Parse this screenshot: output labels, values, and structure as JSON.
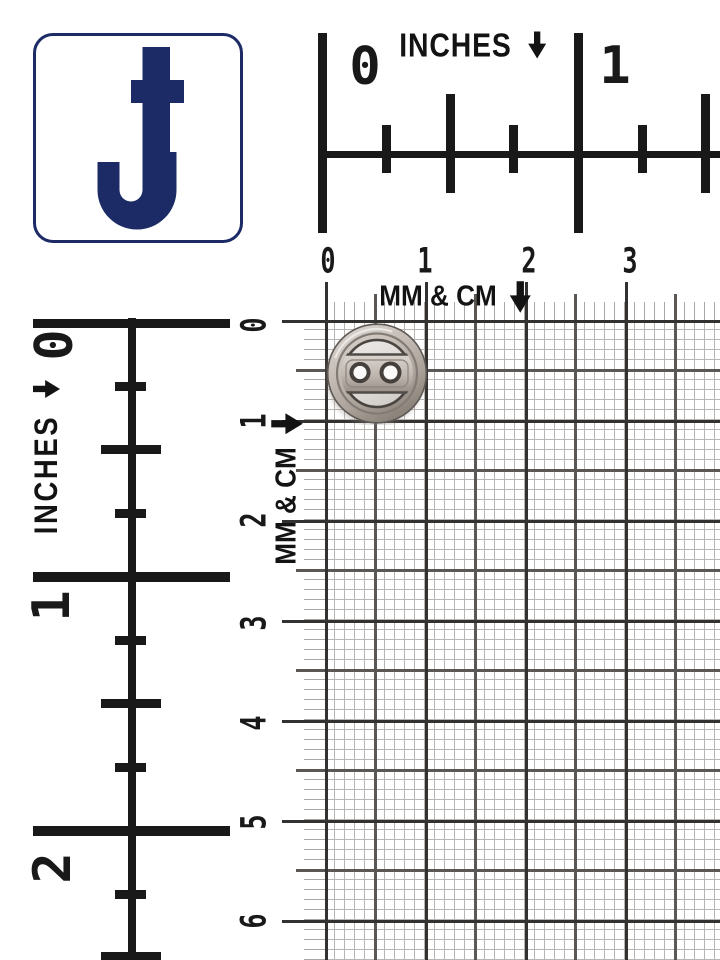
{
  "photo": {
    "description": "Silver two-hole sewing button photographed on millimeter graph paper with inch rulers for scale",
    "background": "#ffffff"
  },
  "logo": {
    "letter": "J",
    "color": "#1c2b66"
  },
  "top_inch_ruler": {
    "label": "INCHES",
    "numbers": [
      "0",
      "1"
    ]
  },
  "left_inch_ruler": {
    "label": "INCHES",
    "numbers": [
      "0",
      "1",
      "2"
    ]
  },
  "mm_cm_grid": {
    "label": "MM & CM",
    "x_numbers": [
      "0",
      "1",
      "2",
      "3"
    ],
    "y_numbers": [
      "0",
      "1",
      "2",
      "3",
      "4",
      "5",
      "6"
    ]
  },
  "button": {
    "type": "two-hole metal button",
    "finish": "silver",
    "holes": 2,
    "diameter_cm": 1
  },
  "colors": {
    "ink": "#191919",
    "navy": "#1c2b66",
    "grid_mm_line": "#b7b4b1",
    "grid_5mm_line": "#5b5754",
    "grid_cm_line": "#343230",
    "button_metal": "#c3bbb4"
  }
}
